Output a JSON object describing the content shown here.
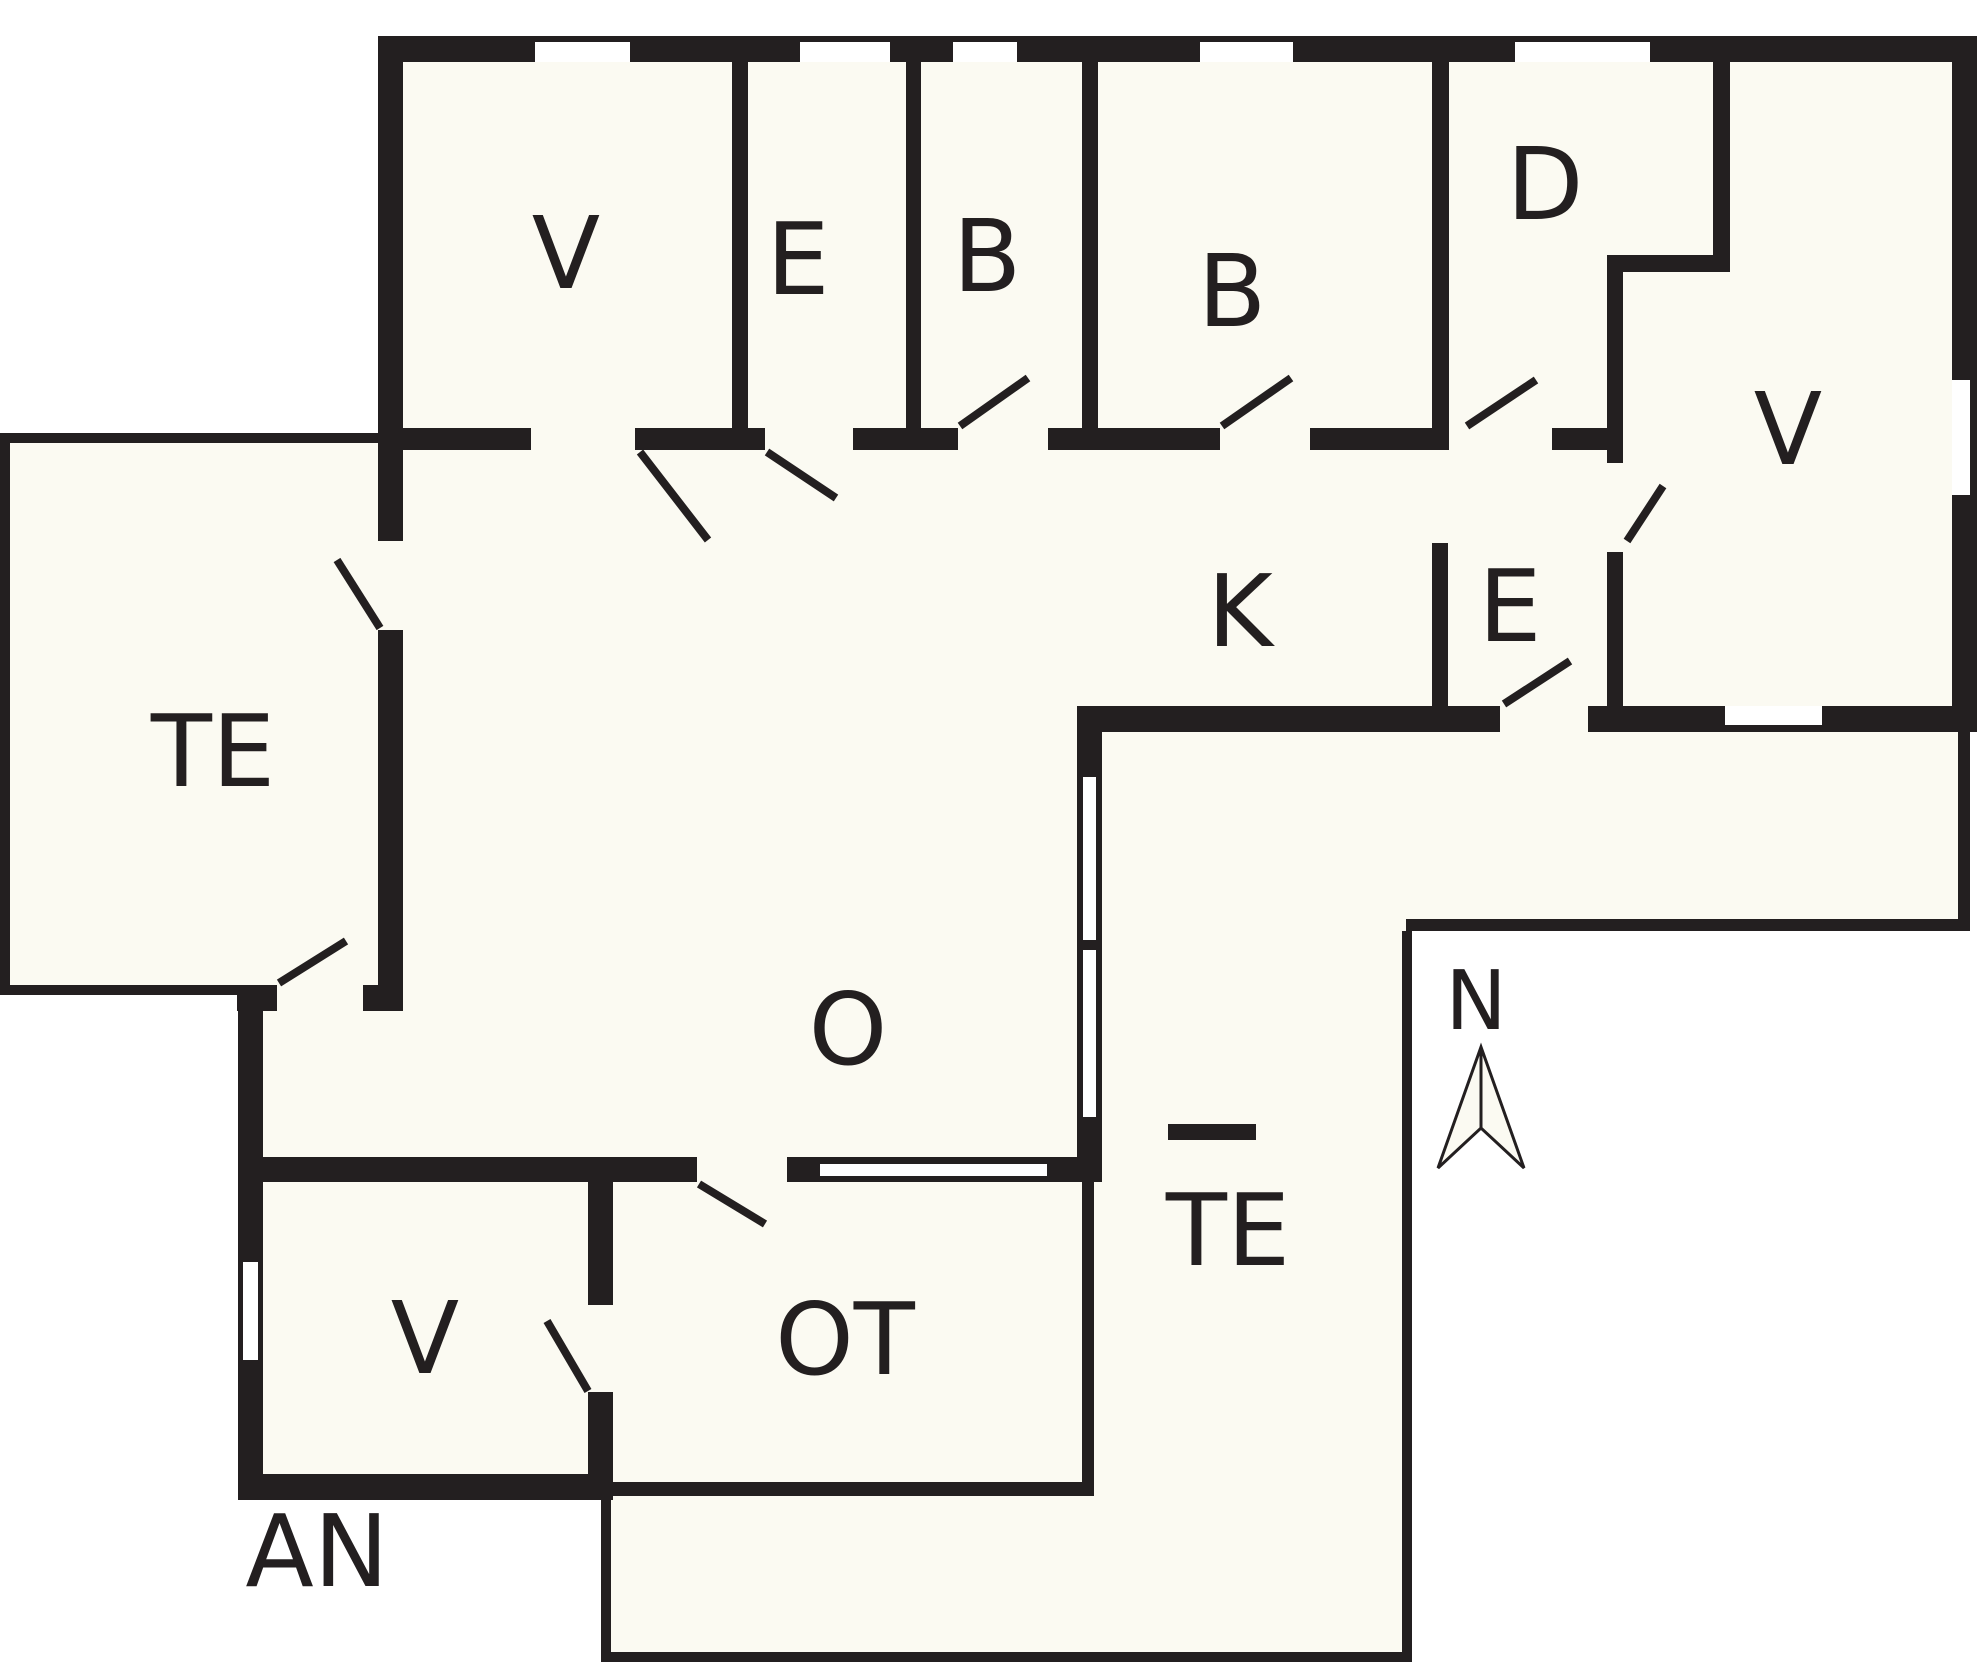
{
  "title": "Holiday house floor plan",
  "canvas": {
    "width": 1980,
    "height": 1667
  },
  "colors": {
    "wall": "#231F20",
    "interior": "#FBFAF2",
    "outside": "#FFFFFF",
    "window": "#FFFFFF",
    "label": "#231F20"
  },
  "rooms": [
    {
      "id": "v-top-left",
      "label": "V",
      "x": 566,
      "y": 288
    },
    {
      "id": "e-top",
      "label": "E",
      "x": 798,
      "y": 294
    },
    {
      "id": "b-1",
      "label": "B",
      "x": 987,
      "y": 291
    },
    {
      "id": "b-2",
      "label": "B",
      "x": 1232,
      "y": 326
    },
    {
      "id": "d",
      "label": "D",
      "x": 1545,
      "y": 219
    },
    {
      "id": "v-right",
      "label": "V",
      "x": 1788,
      "y": 464
    },
    {
      "id": "k",
      "label": "K",
      "x": 1240,
      "y": 646
    },
    {
      "id": "e-entry",
      "label": "E",
      "x": 1510,
      "y": 641
    },
    {
      "id": "te-west",
      "label": "TE",
      "x": 213,
      "y": 786
    },
    {
      "id": "o",
      "label": "O",
      "x": 848,
      "y": 1064
    },
    {
      "id": "te-southeast",
      "label": "TE",
      "x": 1228,
      "y": 1265
    },
    {
      "id": "v-annex",
      "label": "V",
      "x": 425,
      "y": 1373
    },
    {
      "id": "ot",
      "label": "OT",
      "x": 845,
      "y": 1374
    },
    {
      "id": "an",
      "label": "AN",
      "x": 317,
      "y": 1586
    }
  ],
  "compass": {
    "label": "N",
    "label_x": 1476,
    "label_y": 1029,
    "arrow_points": "1481,1047 1524,1168 1481,1128 1438,1168",
    "center_line": [
      1481,
      1047,
      1481,
      1128
    ]
  },
  "floorplan": {
    "label_font_size": 100,
    "compass_font_size": 82,
    "door_stroke": 8,
    "fills": [
      {
        "name": "fill-top-band",
        "r": [
          378,
          36,
          1599,
          696
        ]
      },
      {
        "name": "fill-o",
        "r": [
          403,
          445,
          699,
          737
        ]
      },
      {
        "name": "fill-o-west-bump",
        "r": [
          263,
          985,
          140,
          197
        ]
      },
      {
        "name": "fill-te-west",
        "r": [
          0,
          433,
          378,
          562
        ]
      },
      {
        "name": "fill-annex",
        "r": [
          238,
          1157,
          375,
          343
        ]
      },
      {
        "name": "fill-ot",
        "r": [
          613,
          1182,
          489,
          314
        ]
      },
      {
        "name": "fill-te-se-vertical",
        "r": [
          1102,
          732,
          310,
          930
        ]
      },
      {
        "name": "fill-te-se-bottom",
        "r": [
          601,
          1496,
          811,
          166
        ]
      },
      {
        "name": "fill-porch-band",
        "r": [
          1412,
          732,
          558,
          199
        ]
      }
    ],
    "thin_outlines": [
      {
        "name": "te-west-outline-top",
        "r": [
          0,
          433,
          378,
          10
        ]
      },
      {
        "name": "te-west-outline-left",
        "r": [
          0,
          433,
          10,
          562
        ]
      },
      {
        "name": "te-west-outline-bottom",
        "r": [
          0,
          985,
          240,
          10
        ]
      },
      {
        "name": "te-se-outline-right",
        "r": [
          1402,
          931,
          10,
          731
        ]
      },
      {
        "name": "te-se-outline-bottom",
        "r": [
          601,
          1652,
          811,
          10
        ]
      },
      {
        "name": "te-se-outline-left",
        "r": [
          601,
          1496,
          10,
          166
        ]
      }
    ],
    "walls": [
      {
        "name": "wall-top",
        "r": [
          378,
          36,
          1599,
          26
        ]
      },
      {
        "name": "wall-west-upper",
        "r": [
          378,
          36,
          25,
          505
        ]
      },
      {
        "name": "wall-west-lower",
        "r": [
          378,
          630,
          25,
          381
        ]
      },
      {
        "name": "wall-west-jog-left",
        "r": [
          237,
          985,
          40,
          26
        ]
      },
      {
        "name": "wall-west-jog-right",
        "r": [
          363,
          985,
          40,
          26
        ]
      },
      {
        "name": "wall-annex-west",
        "r": [
          238,
          985,
          25,
          515
        ]
      },
      {
        "name": "wall-annex-south",
        "r": [
          238,
          1474,
          375,
          26
        ]
      },
      {
        "name": "wall-annex-east-upper",
        "r": [
          588,
          1157,
          25,
          148
        ]
      },
      {
        "name": "wall-annex-east-lower",
        "r": [
          588,
          1392,
          25,
          105
        ]
      },
      {
        "name": "wall-o-south-left",
        "r": [
          240,
          1157,
          457,
          25
        ]
      },
      {
        "name": "wall-o-south-right",
        "r": [
          787,
          1157,
          315,
          25
        ]
      },
      {
        "name": "wall-east",
        "r": [
          1952,
          36,
          25,
          696
        ]
      },
      {
        "name": "wall-south-k",
        "r": [
          1077,
          706,
          423,
          26
        ]
      },
      {
        "name": "wall-south-entry",
        "r": [
          1588,
          706,
          364,
          26
        ]
      },
      {
        "name": "wall-v-e",
        "r": [
          732,
          62,
          16,
          366
        ]
      },
      {
        "name": "wall-e-b",
        "r": [
          906,
          62,
          15,
          371
        ]
      },
      {
        "name": "wall-b-b",
        "r": [
          1082,
          62,
          16,
          371
        ]
      },
      {
        "name": "wall-b-d",
        "r": [
          1432,
          62,
          17,
          388
        ]
      },
      {
        "name": "wall-d-step-north",
        "r": [
          1713,
          62,
          17,
          210
        ]
      },
      {
        "name": "wall-d-step-mid",
        "r": [
          1607,
          255,
          123,
          17
        ]
      },
      {
        "name": "wall-d-step-south",
        "r": [
          1607,
          272,
          16,
          191
        ]
      },
      {
        "name": "wall-e-v-lower",
        "r": [
          1607,
          552,
          16,
          154
        ]
      },
      {
        "name": "wall-k-e",
        "r": [
          1432,
          543,
          16,
          163
        ]
      },
      {
        "name": "wall-rooms-south-1",
        "r": [
          402,
          428,
          129,
          22
        ]
      },
      {
        "name": "wall-rooms-south-2",
        "r": [
          635,
          428,
          130,
          22
        ]
      },
      {
        "name": "wall-rooms-south-3",
        "r": [
          853,
          428,
          105,
          22
        ]
      },
      {
        "name": "wall-rooms-south-4",
        "r": [
          1048,
          428,
          172,
          22
        ]
      },
      {
        "name": "wall-rooms-south-5",
        "r": [
          1310,
          428,
          122,
          22
        ]
      },
      {
        "name": "wall-rooms-south-6",
        "r": [
          1552,
          428,
          55,
          22
        ]
      },
      {
        "name": "wall-ot-east-upper",
        "r": [
          1077,
          732,
          25,
          450
        ]
      },
      {
        "name": "wall-ot-east-lower",
        "r": [
          1082,
          1182,
          12,
          314
        ]
      },
      {
        "name": "wall-ot-south",
        "r": [
          613,
          1482,
          480,
          14
        ]
      },
      {
        "name": "wall-porch-east",
        "r": [
          1958,
          732,
          12,
          199
        ]
      },
      {
        "name": "wall-porch-south",
        "r": [
          1406,
          919,
          564,
          12
        ]
      },
      {
        "name": "fireplace-bar",
        "r": [
          1168,
          1124,
          88,
          16
        ]
      }
    ],
    "windows": [
      {
        "name": "window-top-1",
        "r": [
          535,
          42,
          95,
          20
        ]
      },
      {
        "name": "window-top-2",
        "r": [
          800,
          42,
          90,
          20
        ]
      },
      {
        "name": "window-top-3",
        "r": [
          953,
          42,
          64,
          20
        ]
      },
      {
        "name": "window-top-4",
        "r": [
          1200,
          42,
          93,
          20
        ]
      },
      {
        "name": "window-top-5",
        "r": [
          1515,
          42,
          135,
          20
        ]
      },
      {
        "name": "window-east",
        "r": [
          1952,
          380,
          18,
          115
        ]
      },
      {
        "name": "window-south-vright",
        "r": [
          1725,
          706,
          97,
          19
        ]
      },
      {
        "name": "window-o-south",
        "r": [
          820,
          1164,
          227,
          12
        ]
      },
      {
        "name": "window-ot-east-1",
        "r": [
          1083,
          777,
          13,
          163
        ]
      },
      {
        "name": "window-ot-east-2",
        "r": [
          1083,
          950,
          13,
          167
        ]
      },
      {
        "name": "window-annex-west",
        "r": [
          243,
          1262,
          15,
          98
        ]
      }
    ],
    "doors": [
      {
        "name": "door-swing-v-top",
        "l": [
          640,
          452,
          708,
          540
        ]
      },
      {
        "name": "door-swing-e-top",
        "l": [
          767,
          452,
          836,
          498
        ]
      },
      {
        "name": "door-swing-te-west",
        "l": [
          380,
          628,
          337,
          560
        ]
      },
      {
        "name": "door-swing-o-west",
        "l": [
          279,
          983,
          346,
          941
        ]
      },
      {
        "name": "door-swing-b1",
        "l": [
          960,
          426,
          1028,
          378
        ]
      },
      {
        "name": "door-swing-b2",
        "l": [
          1222,
          426,
          1291,
          378
        ]
      },
      {
        "name": "door-swing-d",
        "l": [
          1467,
          426,
          1536,
          380
        ]
      },
      {
        "name": "door-swing-entry",
        "l": [
          1504,
          704,
          1570,
          661
        ]
      },
      {
        "name": "door-swing-e-v",
        "l": [
          1627,
          541,
          1663,
          486
        ]
      },
      {
        "name": "door-swing-annex-ot",
        "l": [
          588,
          1391,
          547,
          1321
        ]
      },
      {
        "name": "door-swing-o-ot",
        "l": [
          699,
          1184,
          765,
          1224
        ]
      }
    ]
  }
}
